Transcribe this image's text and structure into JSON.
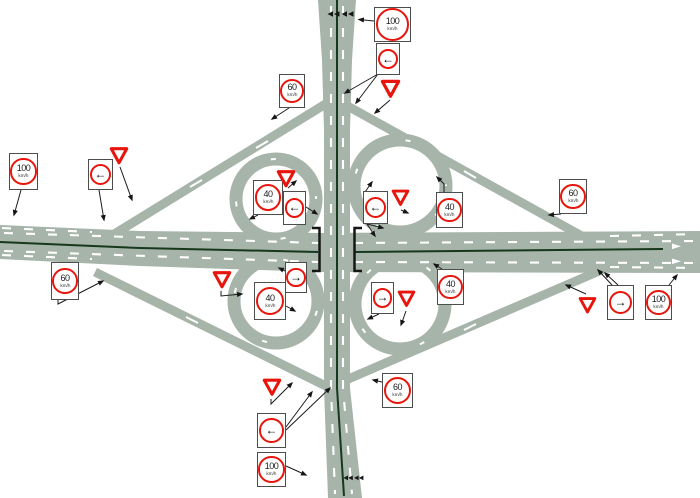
{
  "diagram": {
    "type": "cloverleaf-interchange-signage-plan",
    "description": "Schematic plan of a cloverleaf motorway interchange with posted traffic signs connected by leader lines to their roadside locations"
  },
  "colors": {
    "background": "#ffffff",
    "road_surface": "#a6b4aa",
    "median_line": "#16381c",
    "lane_marking": "#ffffff",
    "sign_red": "#e8150d",
    "sign_box_border": "#4d4d4d",
    "leader_line": "#1c1c1c"
  },
  "road_markings": {
    "median_line": "solid dark centre line on both motorways",
    "lane_dashes": "white broken lane lines",
    "merge_chevrons": "paired black chevrons at top and bottom of the vertical motorway",
    "bridge_brackets": "black bracket marks at the central overpass",
    "lane_arrows": "white lane arrows at the right carriageway end"
  },
  "signs": [
    {
      "id": "speed_100_top",
      "type": "speed_limit",
      "value": "100",
      "unit": "km/h"
    },
    {
      "id": "arrow_top",
      "type": "direction_arrow",
      "glyph": "←",
      "direction": "left"
    },
    {
      "id": "give_way_top",
      "type": "give_way"
    },
    {
      "id": "speed_60_upper_left",
      "type": "speed_limit",
      "value": "60",
      "unit": "km/h"
    },
    {
      "id": "speed_100_left",
      "type": "speed_limit",
      "value": "100",
      "unit": "km/h"
    },
    {
      "id": "arrow_left_side",
      "type": "direction_arrow",
      "glyph": "←",
      "direction": "left"
    },
    {
      "id": "give_way_left",
      "type": "give_way"
    },
    {
      "id": "speed_60_lower_left",
      "type": "speed_limit",
      "value": "60",
      "unit": "km/h"
    },
    {
      "id": "speed_40_nw_loop",
      "type": "speed_limit",
      "value": "40",
      "unit": "km/h"
    },
    {
      "id": "give_way_nw_loop",
      "type": "give_way"
    },
    {
      "id": "arrow_nw_quadrant",
      "type": "direction_arrow",
      "glyph": "←",
      "direction": "left"
    },
    {
      "id": "arrow_center_right",
      "type": "direction_arrow",
      "glyph": "←",
      "direction": "left"
    },
    {
      "id": "give_way_center_right",
      "type": "give_way"
    },
    {
      "id": "speed_40_ne_loop",
      "type": "speed_limit",
      "value": "40",
      "unit": "km/h"
    },
    {
      "id": "arrow_sw_quadrant",
      "type": "direction_arrow",
      "glyph": "→",
      "direction": "right"
    },
    {
      "id": "speed_40_sw_loop",
      "type": "speed_limit",
      "value": "40",
      "unit": "km/h"
    },
    {
      "id": "give_way_sw_loop",
      "type": "give_way"
    },
    {
      "id": "arrow_se_quadrant",
      "type": "direction_arrow",
      "glyph": "→",
      "direction": "right"
    },
    {
      "id": "give_way_se_loop",
      "type": "give_way"
    },
    {
      "id": "speed_40_se_loop",
      "type": "speed_limit",
      "value": "40",
      "unit": "km/h"
    },
    {
      "id": "speed_60_upper_right",
      "type": "speed_limit",
      "value": "60",
      "unit": "km/h"
    },
    {
      "id": "give_way_right",
      "type": "give_way"
    },
    {
      "id": "arrow_right_side",
      "type": "direction_arrow",
      "glyph": "→",
      "direction": "right"
    },
    {
      "id": "speed_100_right",
      "type": "speed_limit",
      "value": "100",
      "unit": "km/h"
    },
    {
      "id": "give_way_bottom",
      "type": "give_way"
    },
    {
      "id": "speed_60_bottom",
      "type": "speed_limit",
      "value": "60",
      "unit": "km/h"
    },
    {
      "id": "arrow_bottom",
      "type": "direction_arrow",
      "glyph": "←",
      "direction": "left"
    },
    {
      "id": "speed_100_bottom",
      "type": "speed_limit",
      "value": "100",
      "unit": "km/h"
    }
  ]
}
